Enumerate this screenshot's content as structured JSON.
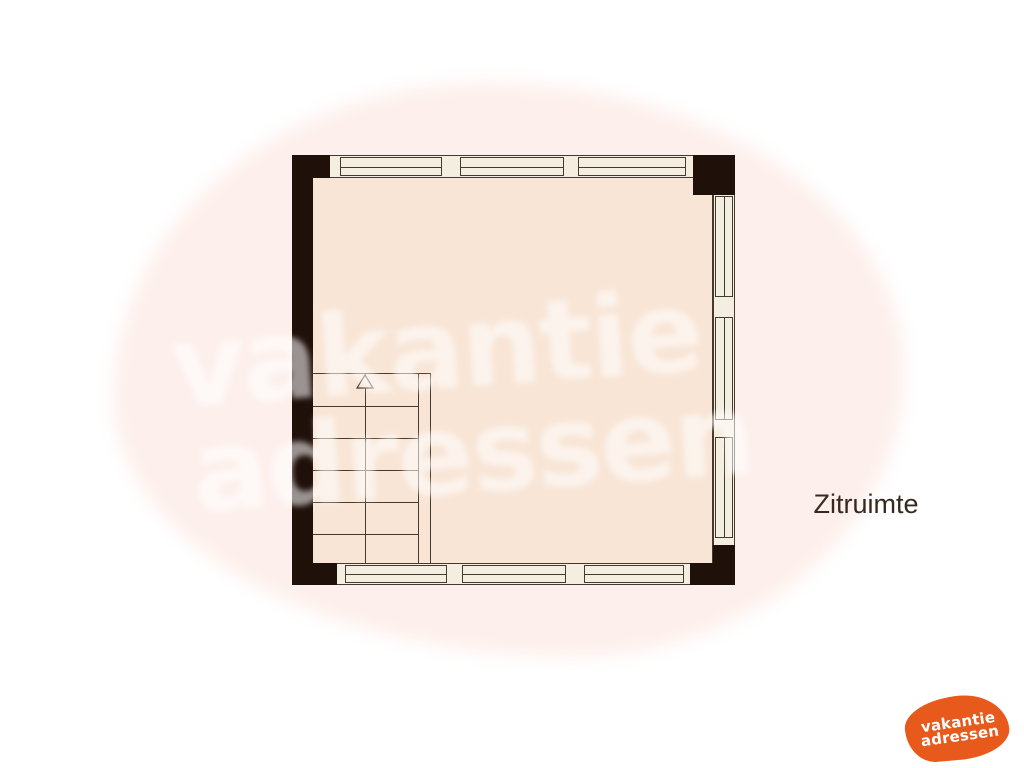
{
  "room": {
    "label": "Zitruimte"
  },
  "stairs": {
    "direction": "up",
    "step_count": 6
  },
  "watermark": {
    "line1": "vakantie",
    "line2": "adressen"
  },
  "logo": {
    "line1": "vakantie",
    "line2": "adressen"
  },
  "colors": {
    "wall": "#20100a",
    "floor": "#f8e5d6",
    "window_fill": "#f4eee1",
    "line": "#463a2e",
    "blob": "#fdf0ec",
    "logo_orange": "#e8591c",
    "label_text": "#37291e"
  }
}
